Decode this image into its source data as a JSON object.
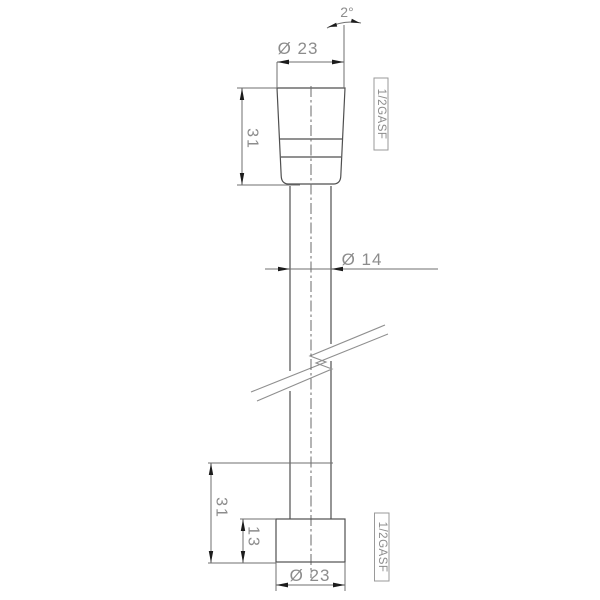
{
  "drawing": {
    "taper_angle_label": "2°",
    "top_fitting": {
      "diameter_label": "Ø 23",
      "length_label": "31",
      "thread_label": "1/2GASF"
    },
    "hose": {
      "diameter_label": "Ø 14"
    },
    "bottom_fitting": {
      "length_label": "31",
      "knurl_height_label": "13",
      "diameter_label": "Ø 23",
      "thread_label": "1/2GASF"
    }
  },
  "colors": {
    "background": "#ffffff",
    "object_line": "#4f4f4f",
    "dimension_line": "#6f6f6f",
    "text": "#8c8c8c",
    "arrowhead": "#1c1c1c",
    "knurl_fill": "#8f8f8f",
    "label_box_border": "#9a9a9a"
  }
}
